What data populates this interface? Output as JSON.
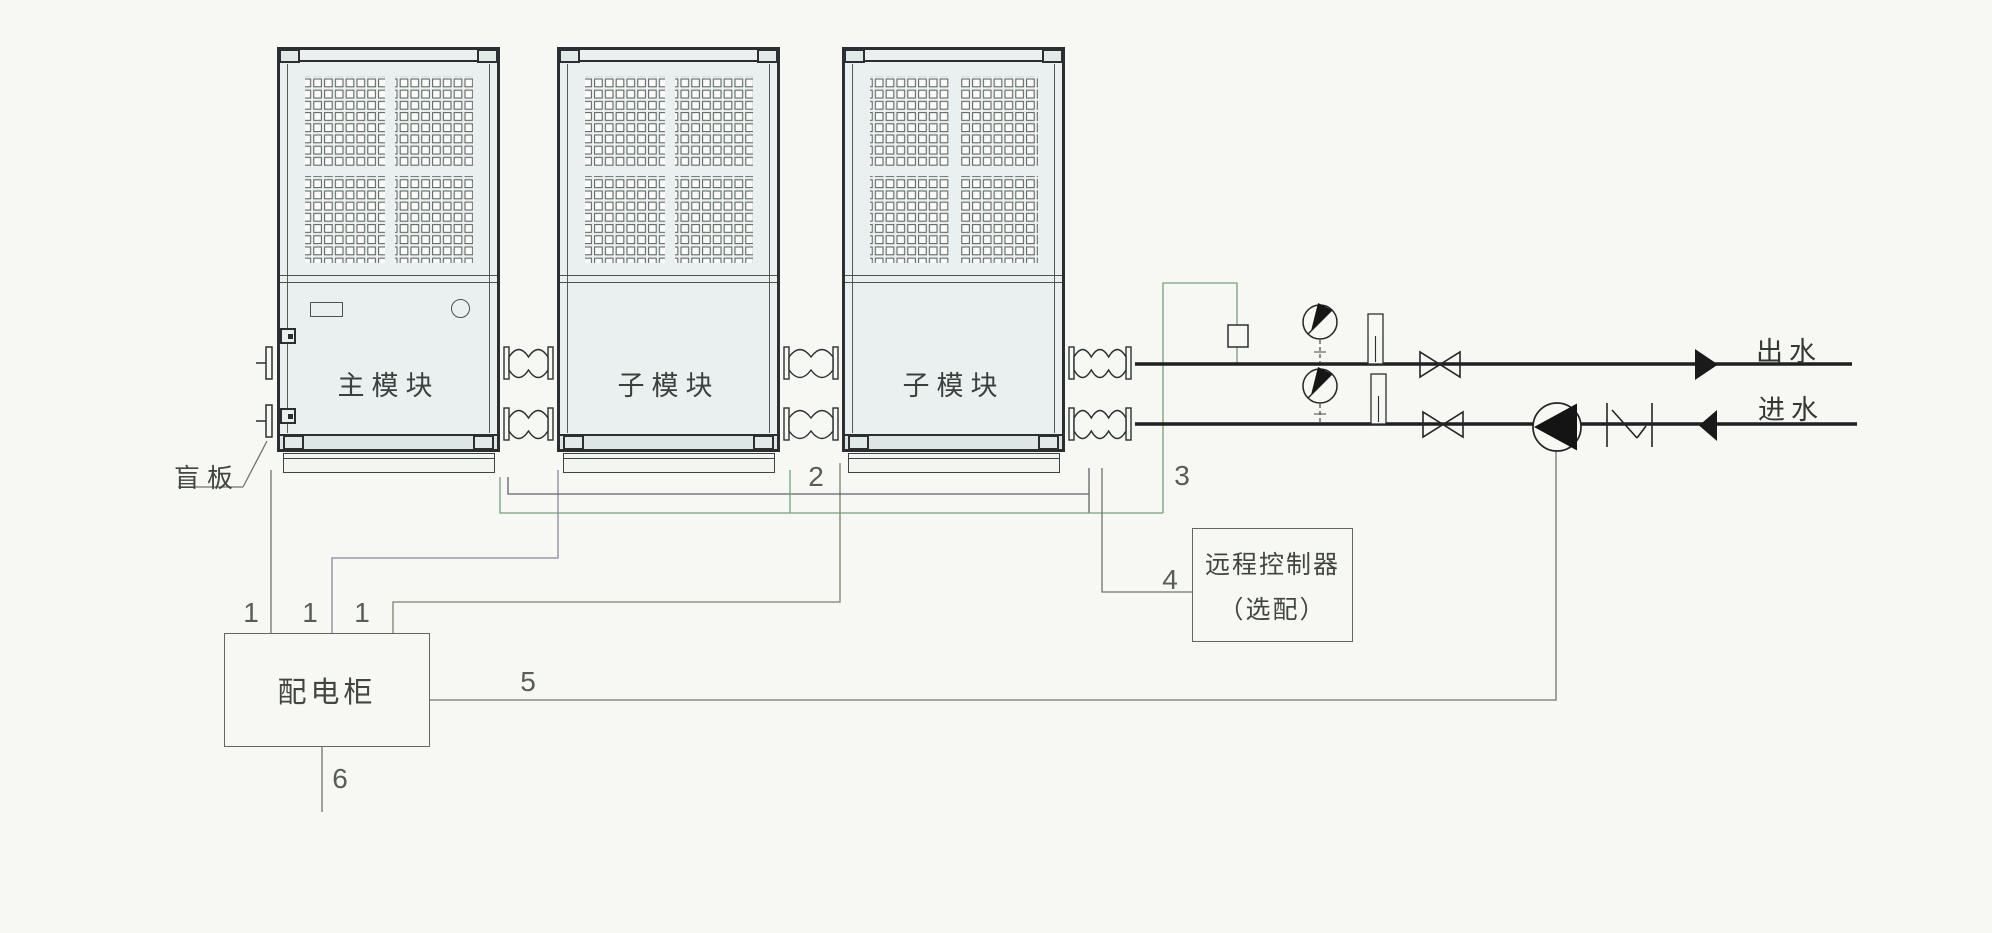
{
  "labels": {
    "module_main": "主模块",
    "module_sub": "子模块",
    "blind_plate": "盲板",
    "outlet": "出水",
    "inlet": "进水",
    "distribution_box": "配电柜",
    "remote_controller_line1": "远程控制器",
    "remote_controller_line2": "（选配）"
  },
  "wire_numbers": {
    "module1_power": "1",
    "module2_power": "1",
    "module3_power": "1",
    "comm": "2",
    "sensor": "3",
    "remote": "4",
    "pump": "5",
    "mains": "6"
  },
  "colors": {
    "line": "#2b2f31",
    "pipe": "#1e2022",
    "wire": "#6f746c",
    "wire_green": "#74a077",
    "wire_purple": "#8d86a0",
    "background": "#f7f8f3",
    "module_fill": "#e9f0ef"
  }
}
